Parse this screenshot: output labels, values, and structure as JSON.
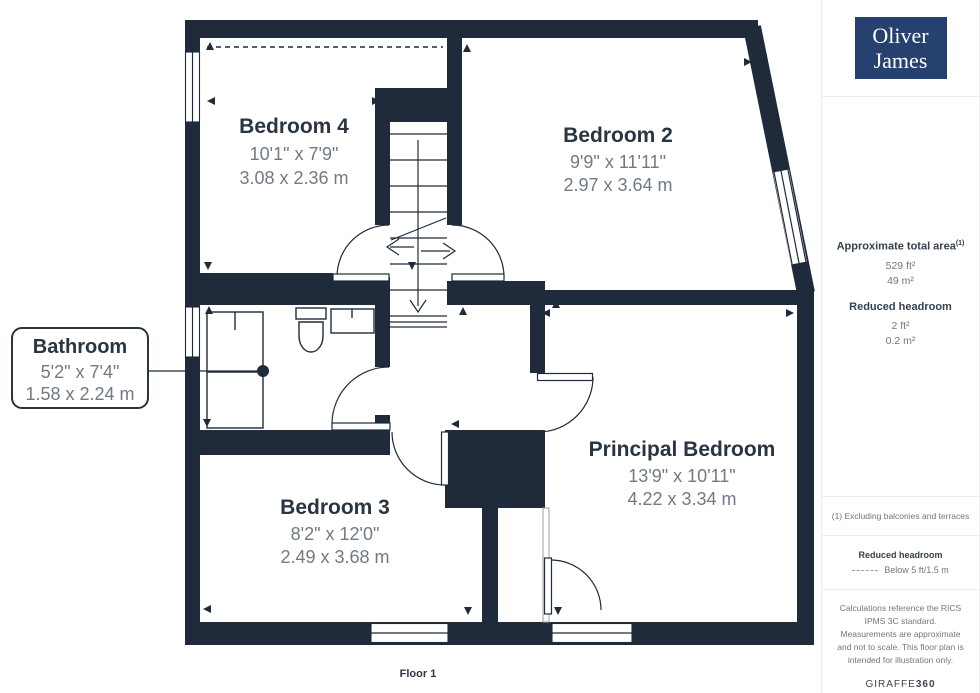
{
  "branding": {
    "logo_line1": "Oliver",
    "logo_line2": "James",
    "brand_regular": "GIRAFFE",
    "brand_bold": "360"
  },
  "floor_label": "Floor 1",
  "rooms": [
    {
      "name": "Bedroom 4",
      "imperial": "10'1\" x 7'9\"",
      "metric": "3.08 x 2.36 m"
    },
    {
      "name": "Bedroom 2",
      "imperial": "9'9\" x 11'11\"",
      "metric": "2.97 x 3.64 m"
    },
    {
      "name": "Bathroom",
      "imperial": "5'2\" x 7'4\"",
      "metric": "1.58 x 2.24 m"
    },
    {
      "name": "Bedroom 3",
      "imperial": "8'2\" x 12'0\"",
      "metric": "2.49 x 3.68 m"
    },
    {
      "name": "Principal Bedroom",
      "imperial": "13'9\" x 10'11\"",
      "metric": "4.22 x 3.34 m"
    }
  ],
  "sidebar": {
    "area_title": "Approximate total area",
    "area_superscript": "(1)",
    "area_imperial": "529 ft²",
    "area_metric": "49 m²",
    "reduced_title": "Reduced headroom",
    "reduced_imperial": "2 ft²",
    "reduced_metric": "0.2 m²",
    "footnote": "(1) Excluding balconies and terraces",
    "legend_title": "Reduced headroom",
    "legend_value": "Below 5 ft/1.5 m",
    "disclaimer": "Calculations reference the RICS IPMS 3C standard. Measurements are approximate and not to scale. This floor plan is intended for illustration only."
  },
  "colors": {
    "wall": "#1f2b3a",
    "room_name": "#2a3542",
    "dimension_text": "#707a85",
    "logo_background": "#26406f",
    "sidebar_text": "#6e7780"
  }
}
